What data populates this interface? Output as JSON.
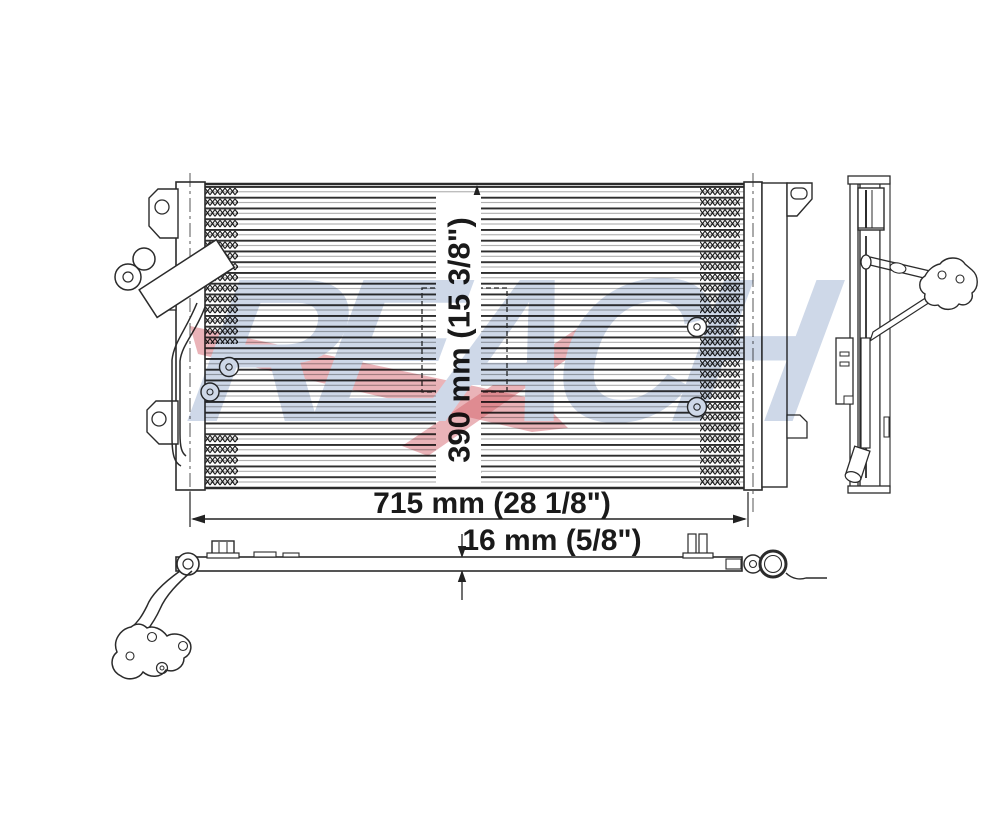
{
  "drawing": {
    "subject": "A/C condenser technical line drawing, front view with side profile and top profile",
    "line_color": "#2b2b2b"
  },
  "dimensions": {
    "height": {
      "label": "390 mm (15 3/8\")"
    },
    "width": {
      "label": "715 mm (28 1/8\")"
    },
    "depth": {
      "label": "16 mm (5/8\")"
    }
  },
  "watermark": {
    "text": "REACH",
    "letter_color": "#c9d4e6",
    "swoosh_color": "#cc4450"
  }
}
